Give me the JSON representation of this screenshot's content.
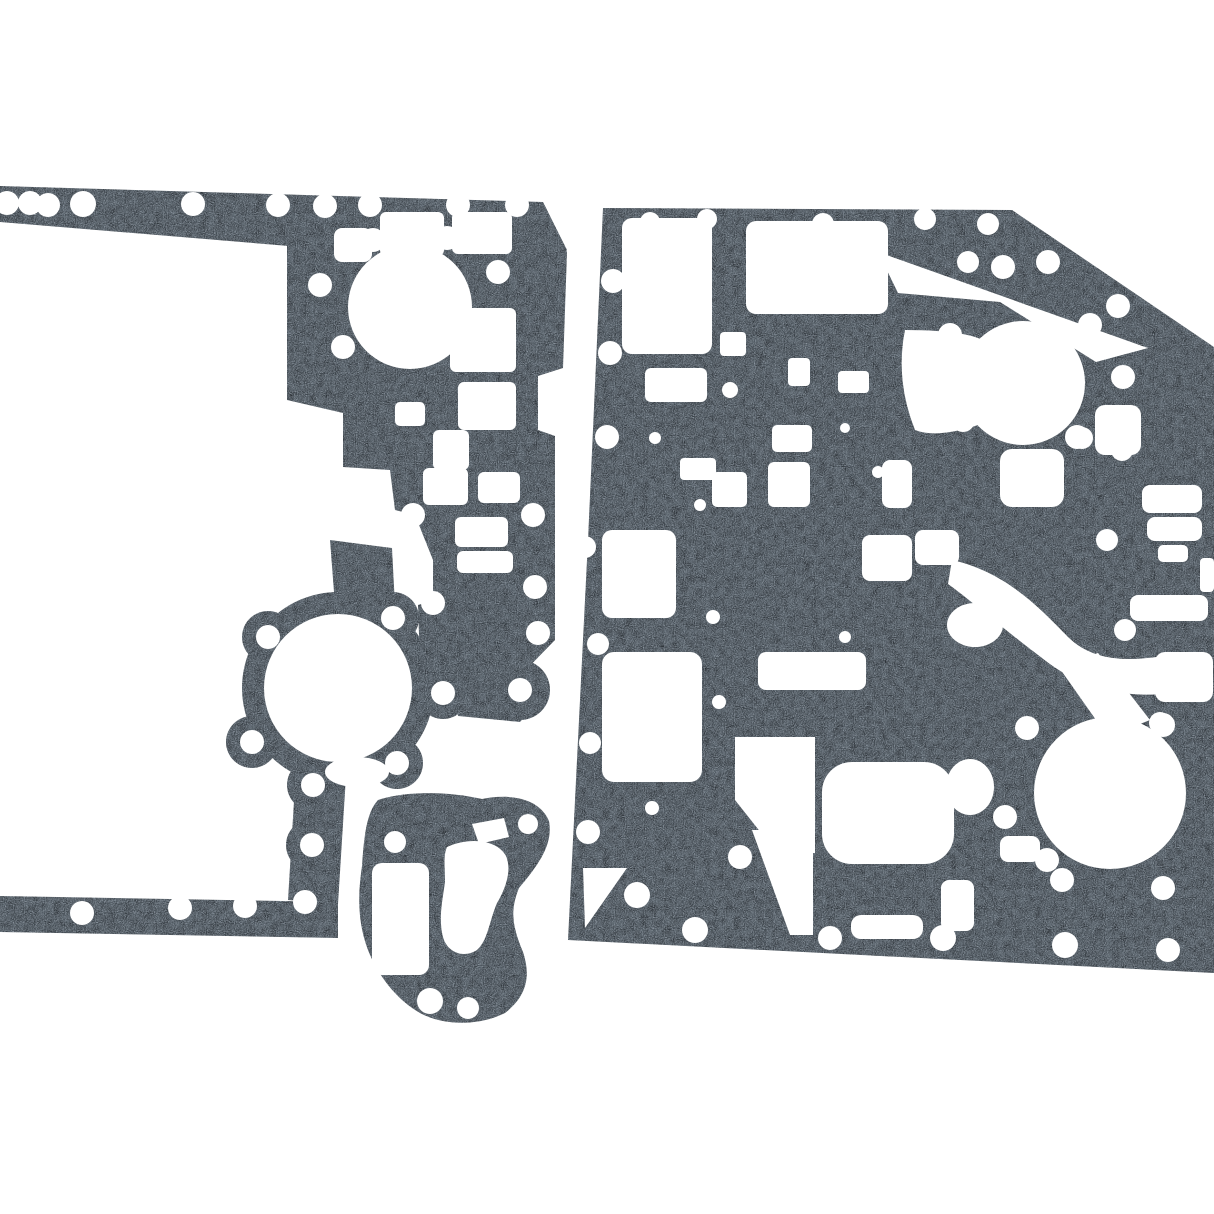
{
  "scene": {
    "type": "product-photo",
    "alt": "Product photo of a die-cut engine gasket set: three dark speckled fiber gaskets laid flat on a plain white background",
    "background_color": "#ffffff"
  },
  "palette": {
    "gasket_base": "#49525a",
    "speckle_light": "#9aa3ab",
    "speckle_dark": "#23292e",
    "hole_color": "#ffffff"
  },
  "pieces": [
    {
      "id": "front-cover-perimeter-gasket",
      "label": "Large perimeter front-cover gasket, partially cropped at the left edge, with two large round ports and stair-step cutouts",
      "position": "left",
      "large_round_ports": 2,
      "bolt_holes_visible": 33
    },
    {
      "id": "valve-plate-gasket",
      "label": "Large rectangular plate gasket with dense rectangular oil passages, two large round ports and many bolt holes, cropped at the right edge",
      "position": "right",
      "large_round_ports": 2,
      "bolt_holes_visible": 40
    },
    {
      "id": "water-outlet-gasket",
      "label": "Small outlet gasket with one rectangular and one kidney-shaped passage and four bolt holes",
      "position": "bottom-center",
      "large_round_ports": 0,
      "bolt_holes_visible": 4
    }
  ]
}
